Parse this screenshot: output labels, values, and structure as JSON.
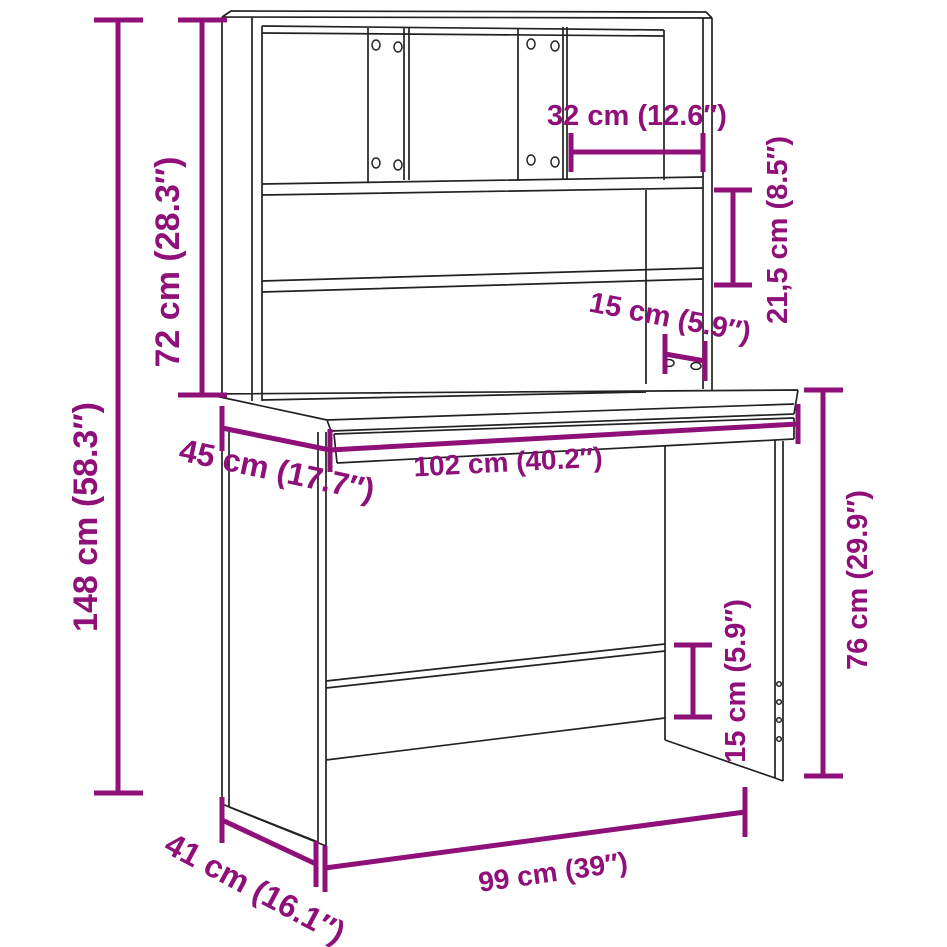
{
  "page": {
    "background": "#ffffff"
  },
  "diagram": {
    "type": "furniture-dimension-diagram",
    "subject": "desk-with-hutch-shelving-unit",
    "colors": {
      "dimension_annotations": "#8E1078",
      "furniture_outline": "#222222",
      "background": "#ffffff"
    },
    "dimensions": {
      "total_height": {
        "label": "148 cm (58.3″)",
        "cm": "148",
        "inch": "58.3"
      },
      "hutch_height": {
        "label": "72 cm (28.3″)",
        "cm": "72",
        "inch": "28.3"
      },
      "compartment_width": {
        "label": "32 cm (12.6″)",
        "cm": "32",
        "inch": "12.6"
      },
      "shelf_spacing": {
        "label": "21,5 cm (8.5″)",
        "cm": "21,5",
        "inch": "8.5"
      },
      "hutch_depth": {
        "label": "15 cm (5.9″)",
        "cm": "15",
        "inch": "5.9"
      },
      "desktop_depth": {
        "label": "45 cm (17.7″)",
        "cm": "45",
        "inch": "17.7"
      },
      "desktop_width": {
        "label": "102 cm (40.2″)",
        "cm": "102",
        "inch": "40.2"
      },
      "desk_height": {
        "label": "76 cm (29.9″)",
        "cm": "76",
        "inch": "29.9"
      },
      "back_panel_height": {
        "label": "15 cm (5.9″)",
        "cm": "15",
        "inch": "5.9"
      },
      "base_width": {
        "label": "99 cm (39″)",
        "cm": "99",
        "inch": "39"
      },
      "base_depth": {
        "label": "41 cm (16.1″)",
        "cm": "41",
        "inch": "16.1"
      }
    }
  }
}
